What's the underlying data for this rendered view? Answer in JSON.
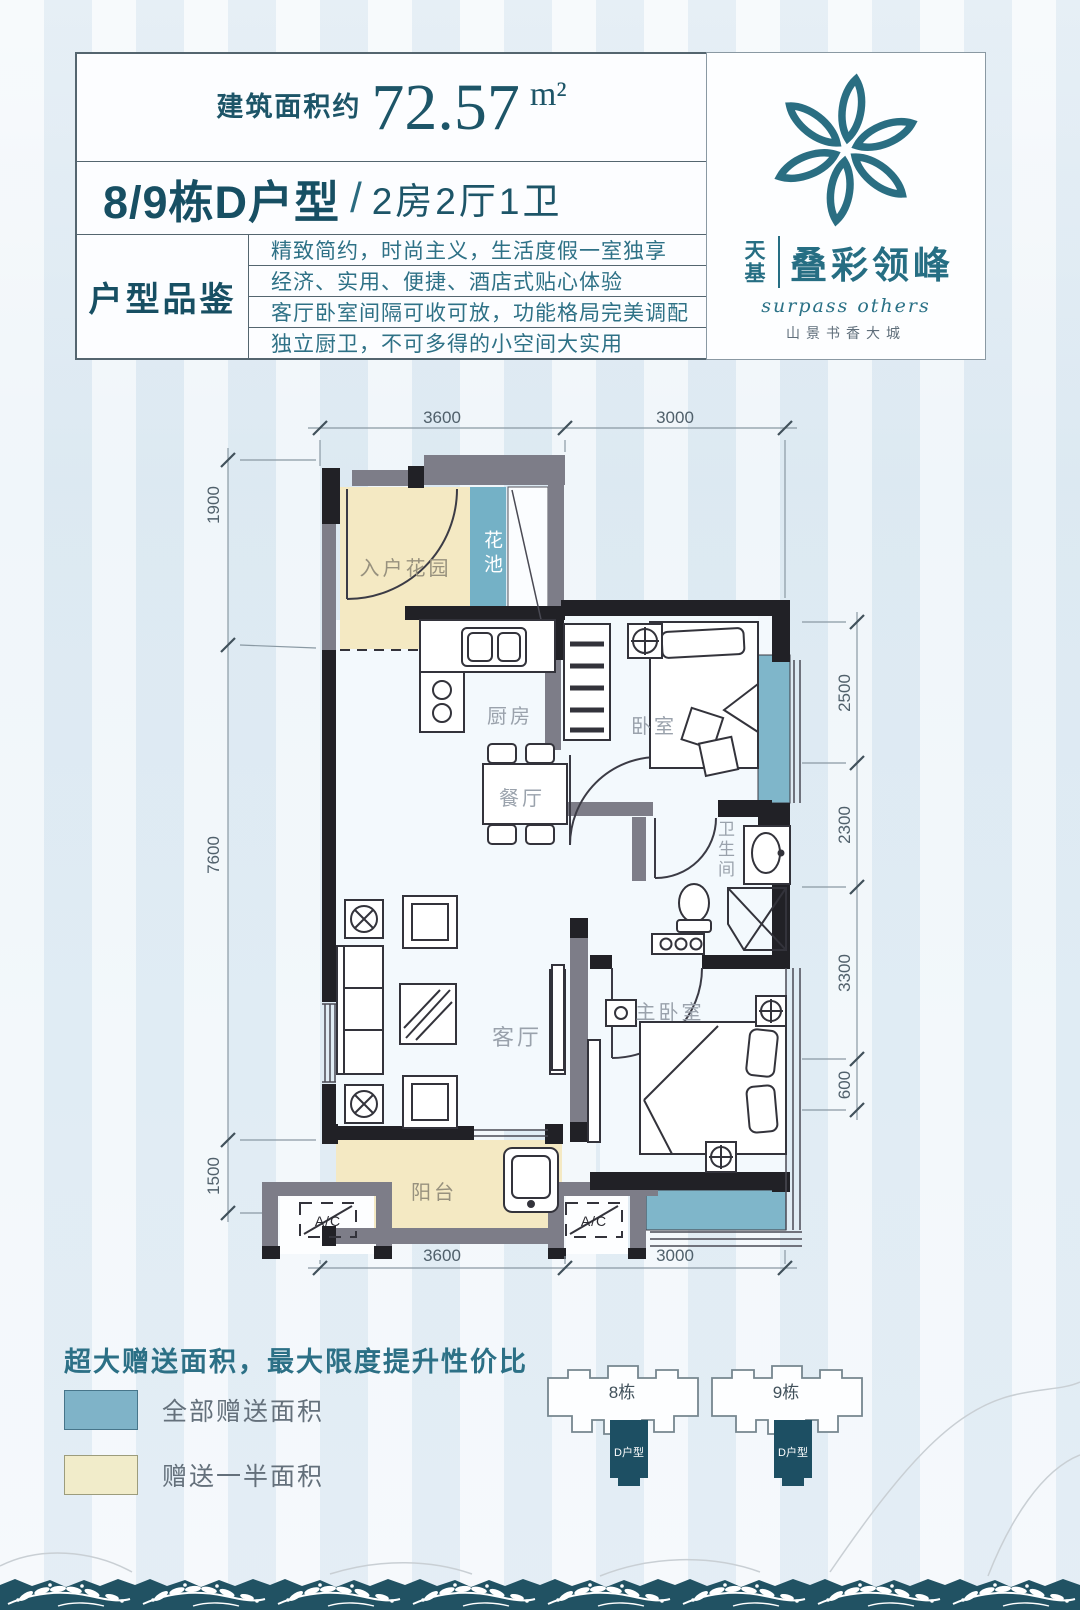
{
  "header": {
    "area_label": "建筑面积约",
    "area_value": "72.57",
    "area_unit": "m²",
    "title_main": "8/9栋D户型",
    "title_sep": "/",
    "title_sub": "2房2厅1卫",
    "review_label": "户型品鉴",
    "review_lines": [
      "精致简约，时尚主义，生活度假一室独享",
      "经济、实用、便捷、酒店式贴心体验",
      "客厅卧室间隔可收可放，功能格局完美调配",
      "独立厨卫，不可多得的小空间大实用"
    ]
  },
  "logo": {
    "brand_left": "天基",
    "brand_right": "叠彩领峰",
    "tagline_en": "surpass others",
    "tagline_cn": "山景书香大城",
    "accent_color": "#266e83"
  },
  "floorplan": {
    "rooms": {
      "entry_garden": "入户花园",
      "flower_bed": "花池",
      "kitchen": "厨房",
      "dining": "餐厅",
      "bedroom": "卧室",
      "bathroom": "卫生间",
      "living": "客厅",
      "master": "主卧室",
      "balcony": "阳台"
    },
    "ac_label": "A/C",
    "dims": {
      "top": [
        "3600",
        "3000"
      ],
      "bottom": [
        "3600",
        "3000"
      ],
      "left": [
        "1900",
        "7600",
        "1500"
      ],
      "right": [
        "2500",
        "2300",
        "3300",
        "600"
      ]
    },
    "colors": {
      "full_gift": "#7fb3c8",
      "half_gift": "#f4e9c3",
      "wall_dark": "#212126",
      "wall_gray": "#7d7d88"
    }
  },
  "legend": {
    "title": "超大赠送面积，最大限度提升性价比",
    "items": [
      {
        "label": "全部赠送面积",
        "color": "#7fb3c8"
      },
      {
        "label": "赠送一半面积",
        "color": "#f1ecca"
      }
    ]
  },
  "keyplan": {
    "buildings": [
      {
        "name": "8栋",
        "unit": "D户型"
      },
      {
        "name": "9栋",
        "unit": "D户型"
      }
    ]
  }
}
